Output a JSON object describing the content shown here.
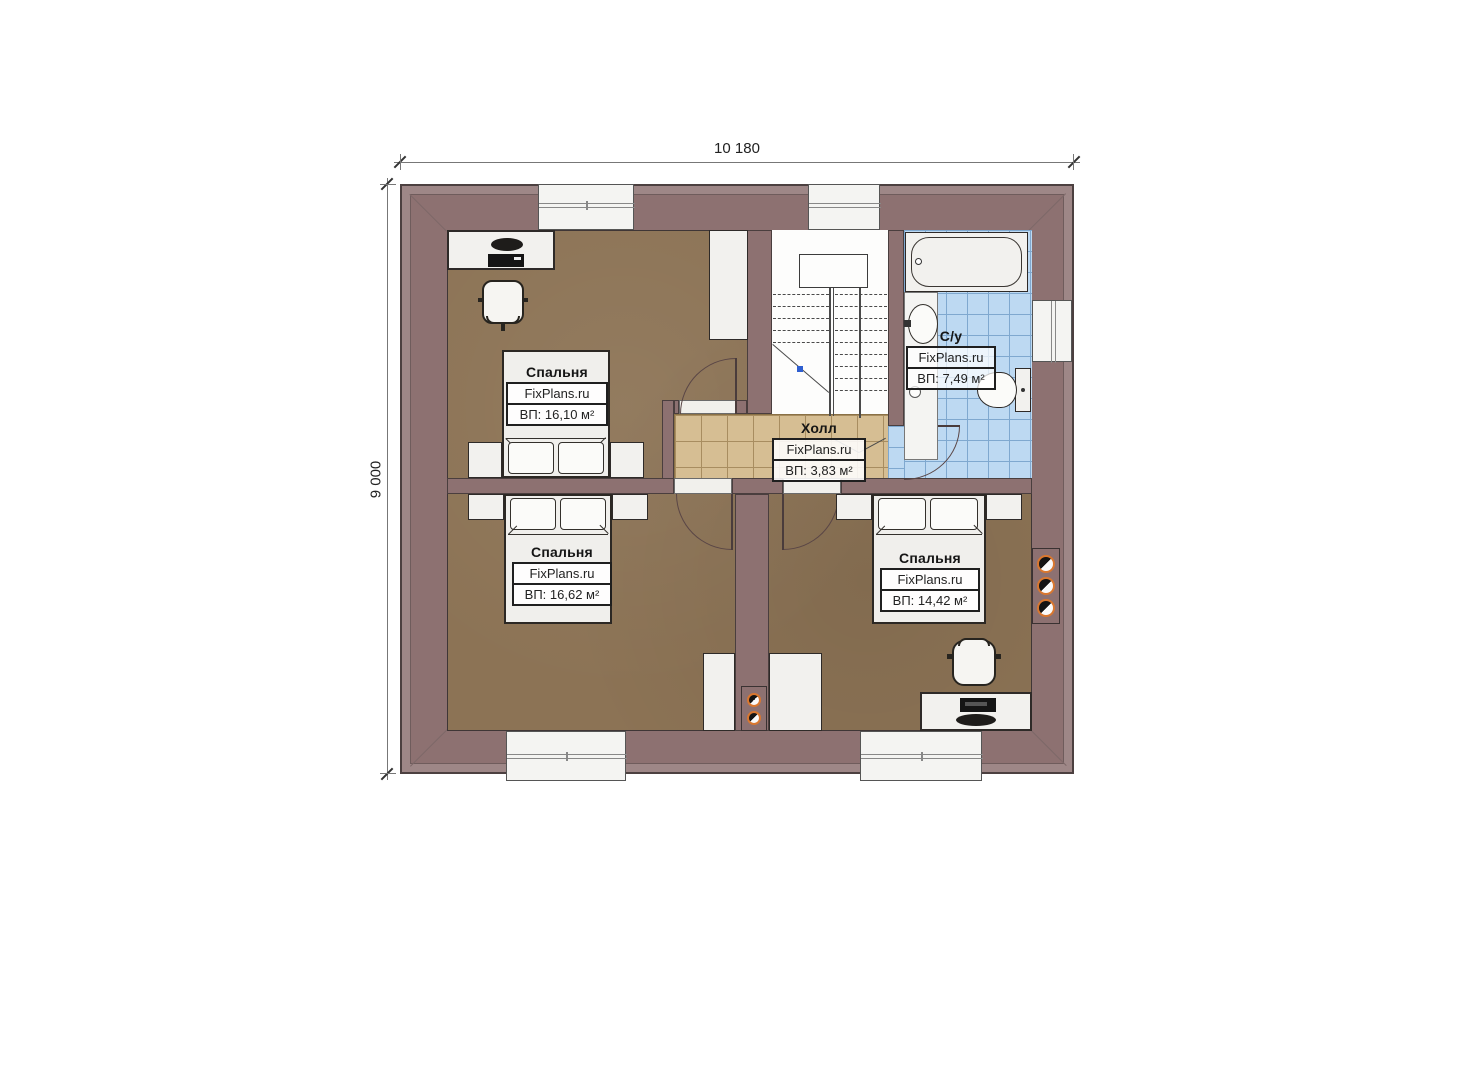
{
  "plan_title": "floor-plan",
  "brand_watermark": "FixPlans.ru",
  "dimensions": {
    "width": "10 180",
    "height": "9 000"
  },
  "rooms": {
    "bedroom_tl": {
      "name": "Спальня",
      "brand": "FixPlans.ru",
      "area": "ВП: 16,10 м²"
    },
    "bedroom_bl": {
      "name": "Спальня",
      "brand": "FixPlans.ru",
      "area": "ВП: 16,62 м²"
    },
    "bedroom_br": {
      "name": "Спальня",
      "brand": "FixPlans.ru",
      "area": "ВП: 14,42 м²"
    },
    "hall": {
      "name": "Холл",
      "brand": "FixPlans.ru",
      "area": "ВП: 3,83 м²"
    },
    "bathroom": {
      "name": "С/у",
      "brand": "FixPlans.ru",
      "area": "ВП: 7,49 м²"
    }
  },
  "fixture_symbols": [
    "bathtub",
    "sink",
    "toilet",
    "staircase",
    "bed",
    "pillow",
    "nightstand",
    "desk",
    "office-chair",
    "window",
    "door-arc",
    "flue-block",
    "vanity-counter",
    "floor-drain"
  ],
  "colors": {
    "wall": "#8d7171",
    "wall_outer_band": "#9e8787",
    "floor_bedroom": "#8c7355",
    "floor_hall": "#d6be93",
    "floor_bathroom": "#bdd9f2",
    "fixture_white": "#f2f1ee",
    "flue_ring": "#d9772f",
    "outline": "#3f3636"
  }
}
